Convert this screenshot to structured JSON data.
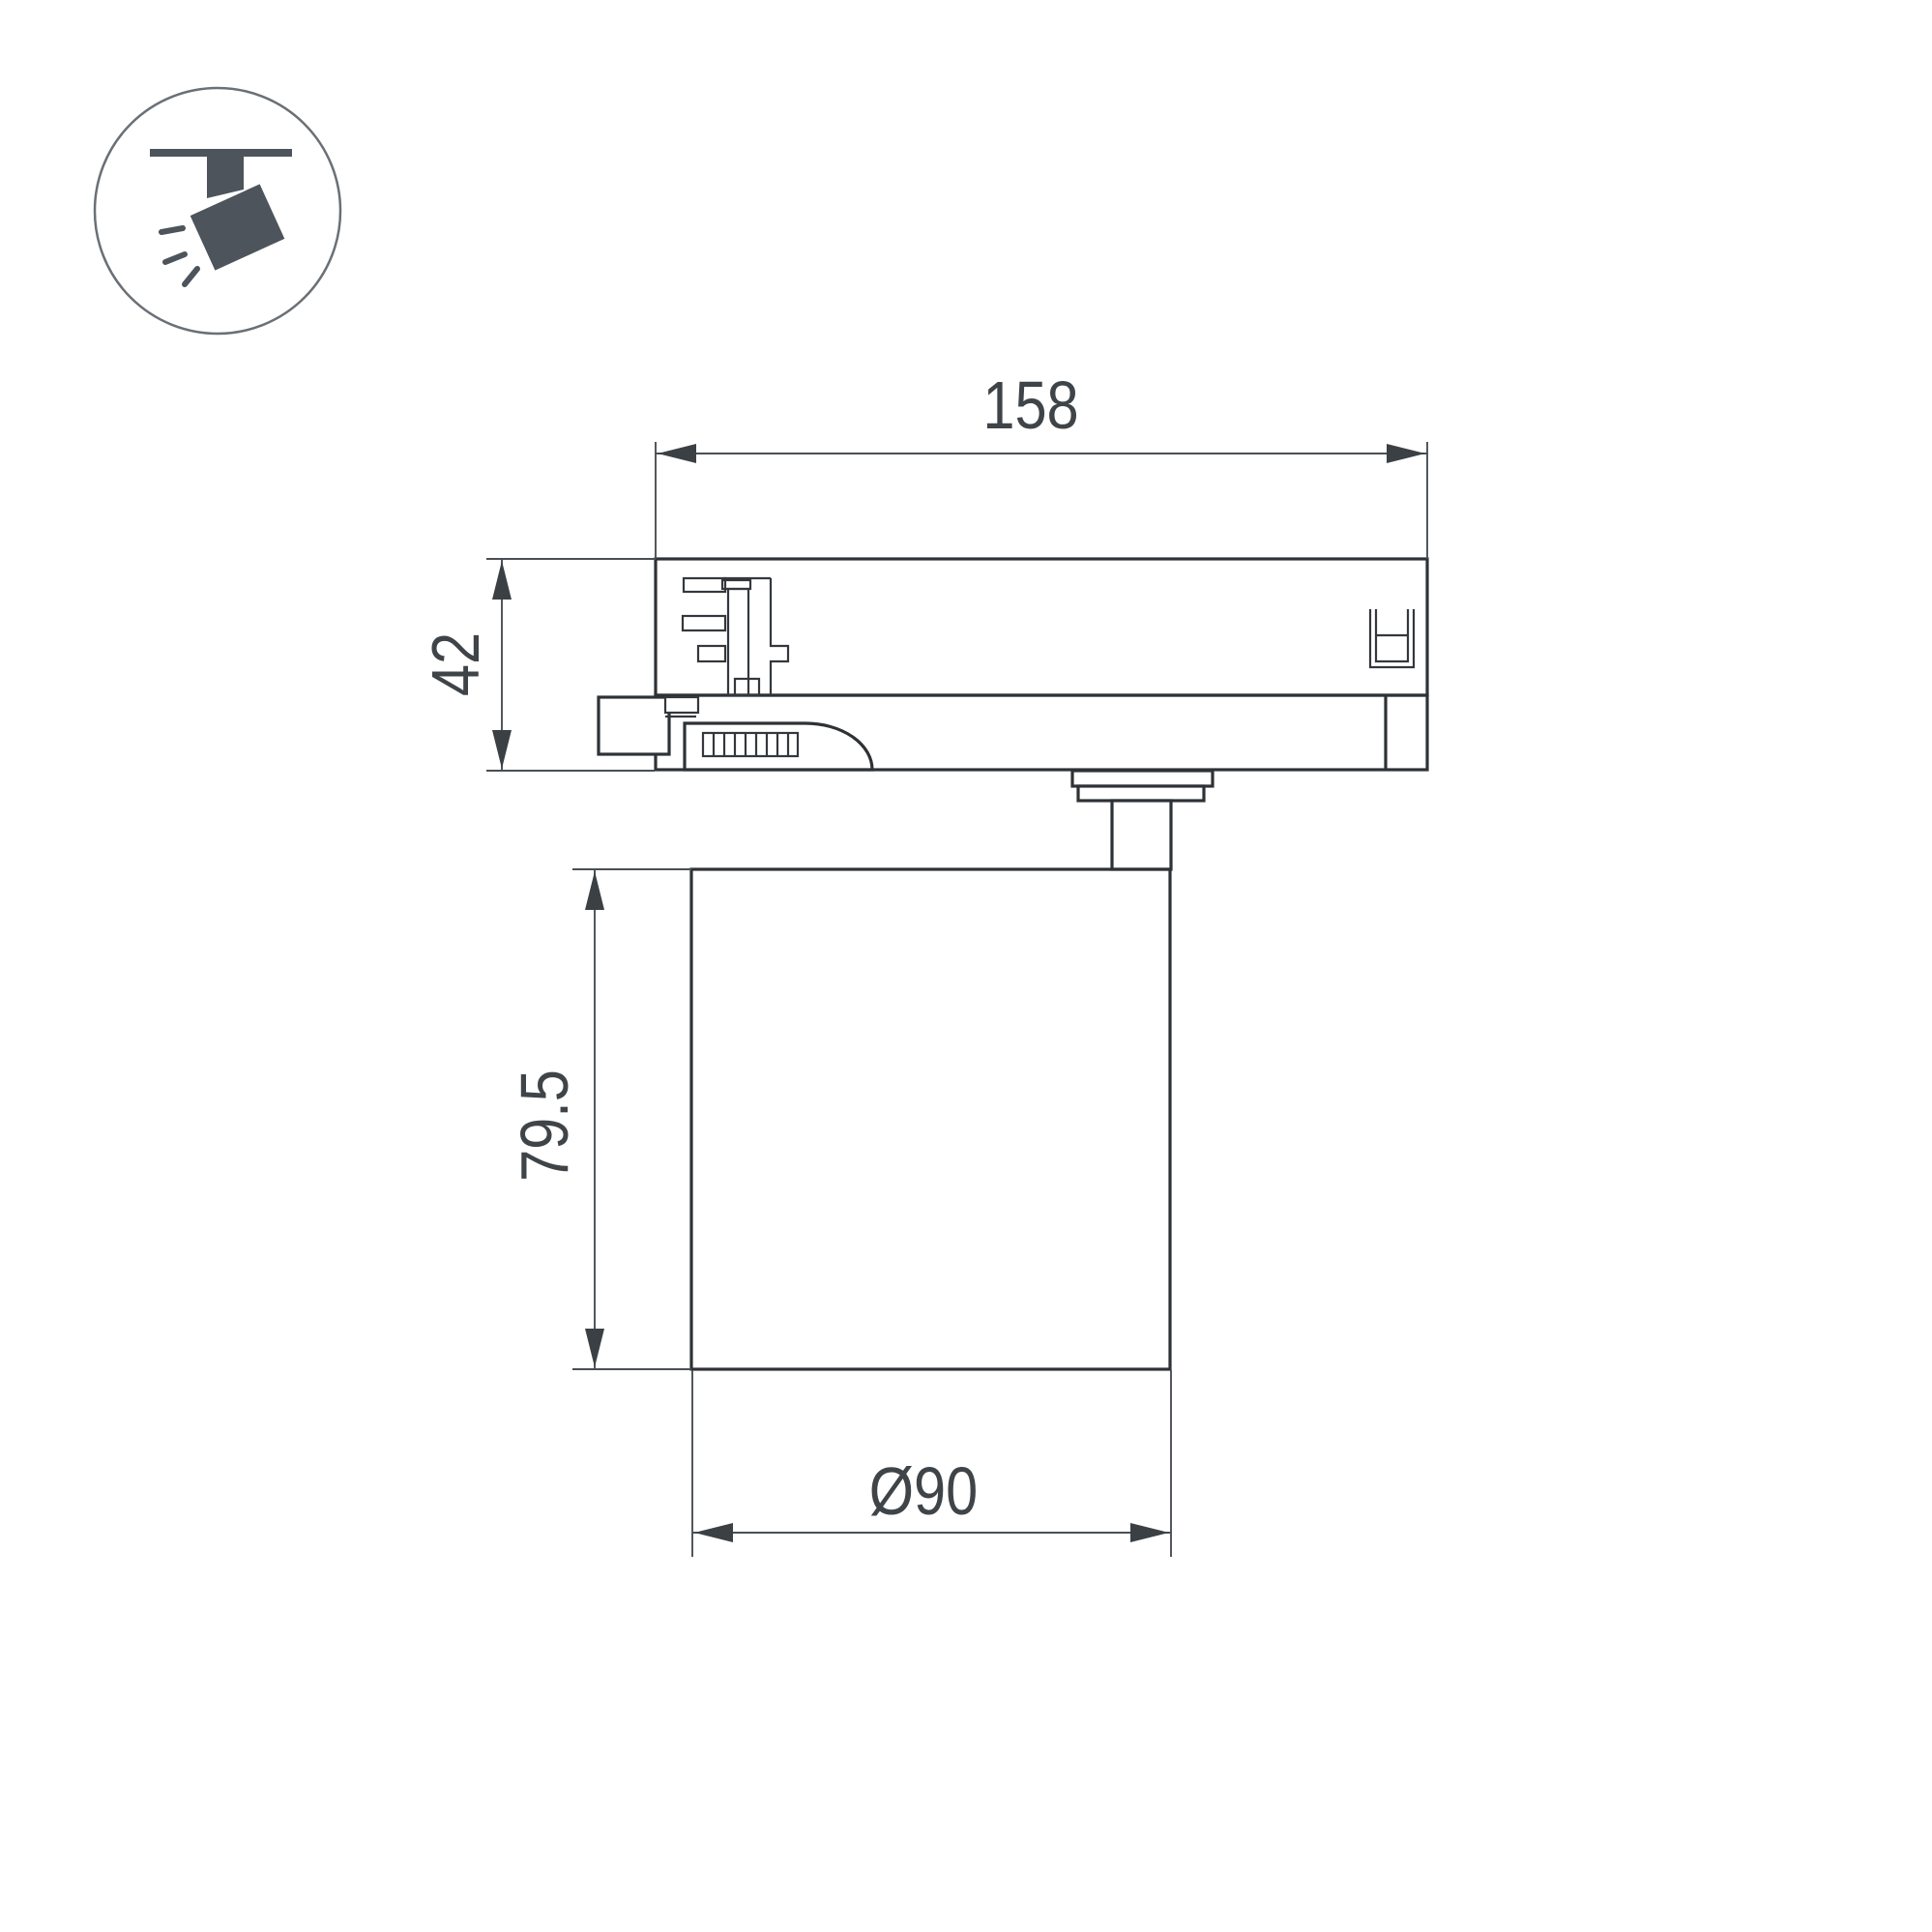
{
  "colors": {
    "background": "#ffffff",
    "line_main": "#2e3236",
    "line_detail": "#34383c",
    "dim_line": "#4a4f54",
    "arrow": "#3b4045",
    "text": "#3f4449",
    "icon_fill": "#4d545b",
    "icon_ring": "#6a7075"
  },
  "icon": {
    "type": "track-spotlight"
  },
  "dimensions": {
    "width": {
      "label": "158"
    },
    "height": {
      "label": "42"
    },
    "body_height": {
      "label": "79.5"
    },
    "diameter": {
      "label": "Ø90"
    }
  }
}
